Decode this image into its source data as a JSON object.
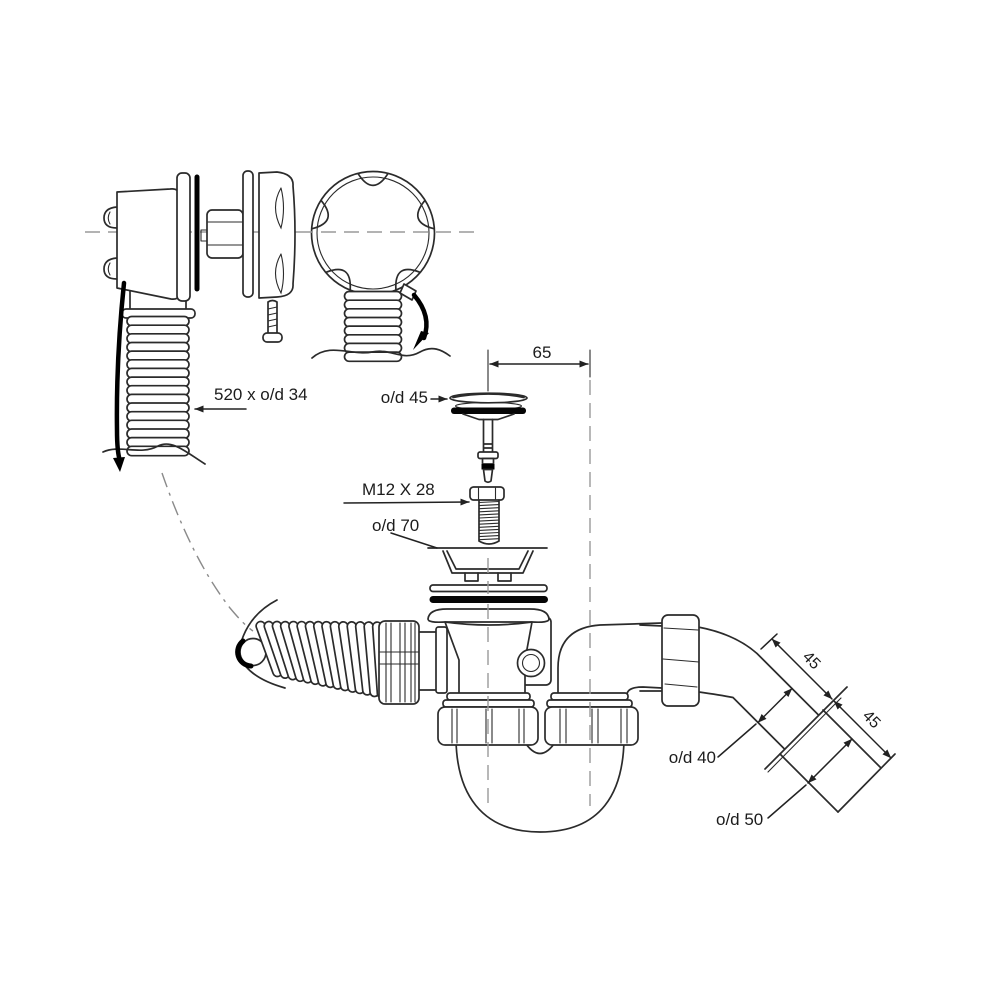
{
  "diagram": {
    "type": "technical-exploded-line-drawing",
    "subject": "bath waste, overflow and trap assembly with dimensions",
    "labels": {
      "hose_dim": "520 x o/d 34",
      "plug_od": "o/d 45",
      "bolt_size": "M12 X 28",
      "flange_od": "o/d 70",
      "offset_dim": "65",
      "inlet_length": "45",
      "socket_length": "45",
      "inlet_od": "o/d 40",
      "socket_od": "o/d 50"
    },
    "colors": {
      "line": "#2b2b2b",
      "heavy": "#000000",
      "centerline": "#9a9a9a",
      "background": "#ffffff"
    }
  }
}
